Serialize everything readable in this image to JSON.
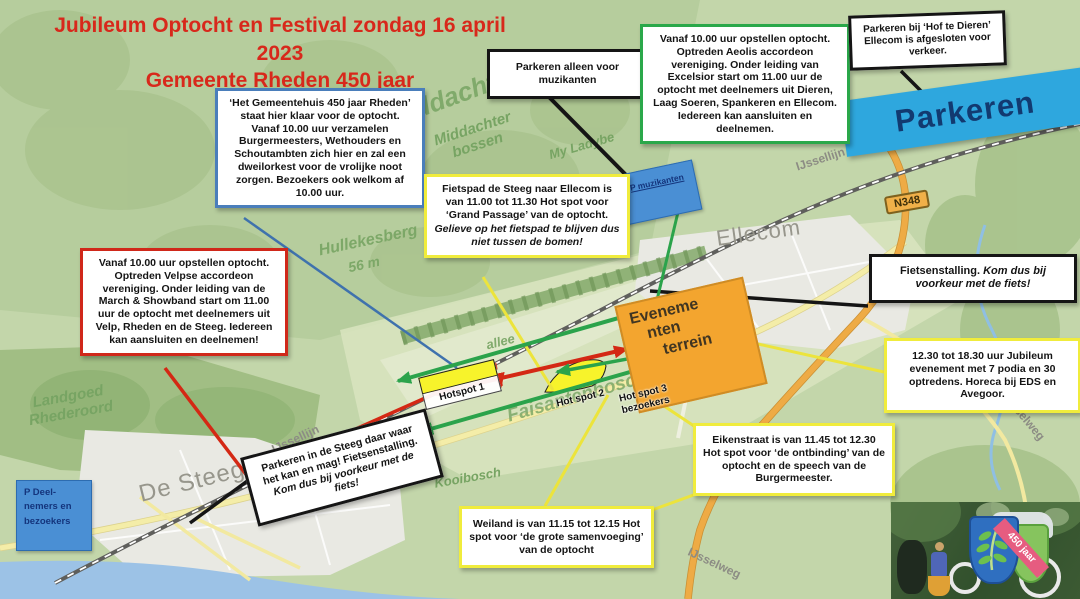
{
  "title": {
    "line1": "Jubileum Optocht en Festival zondag 16 april 2023",
    "line2": "Gemeente Rheden 450 jaar"
  },
  "callouts": {
    "gemeentehuis": {
      "text": "‘Het Gemeentehuis 450 jaar Rheden’ staat hier klaar voor de optocht. Vanaf 10.00 uur verzamelen Burgermeesters, Wethouders en Schoutambten zich hier en zal een dweilorkest voor de vrolijke noot zorgen. Bezoekers ook welkom af 10.00 uur."
    },
    "velp": {
      "text": "Vanaf 10.00 uur opstellen optocht. Optreden Velpse accordeon vereniging. Onder leiding van de March & Showband start om 11.00 uur de optocht met deelnemers uit Velp, Rheden en de Steeg. Iedereen kan aansluiten en deelnemen!"
    },
    "muzikanten": {
      "text": "Parkeren alleen voor muzikanten"
    },
    "dieren": {
      "text": "Vanaf 10.00 uur opstellen optocht. Optreden Aeolis accordeon vereniging. Onder leiding van Excelsior start om 11.00 uur de optocht met deelnemers uit Dieren, Laag Soeren, Spankeren en Ellecom. Iedereen kan aansluiten en deelnemen."
    },
    "hof_te_dieren": {
      "text": "Parkeren bij ‘Hof te Dieren’ Ellecom is afgesloten voor verkeer."
    },
    "fietspad": {
      "text": "Fietspad de Steeg naar Ellecom is van 11.00 tot 11.30 Hot spot voor ‘Grand Passage’ van de optocht.",
      "note": "Gelieve op het fietspad te blijven dus niet tussen de bomen!"
    },
    "fietsenstalling": {
      "lead": "Fietsenstalling.",
      "rest": "Kom dus bij voorkeur met de fiets!"
    },
    "jubileum": {
      "text": "12.30 tot 18.30 uur Jubileum evenement met 7 podia en 30 optredens. Horeca bij EDS en Avegoor."
    },
    "eikenstraat": {
      "text": "Eikenstraat is van 11.45 tot 12.30 Hot spot voor ‘de ontbinding’ van de optocht en de speech van de Burgermeester."
    },
    "weiland": {
      "text": "Weiland is van 11.15 tot 12.15 Hot spot voor ‘de grote samenvoeging’ van de optocht"
    },
    "parkeren_steeg": {
      "lead": "Parkeren in de Steeg daar waar het kan en mag! Fietsenstalling.",
      "rest": "Kom dus bij voorkeur met de fiets!"
    }
  },
  "signs": {
    "parkeren_banner": "Parkeren",
    "p_muzikanten": "P muzikanten",
    "p_deelnemers": {
      "lines": [
        "P Deel-",
        "nemers en",
        "bezoekers"
      ]
    },
    "evenemententerrein": {
      "lines": [
        "Eveneme",
        "nten",
        "terrein"
      ]
    },
    "hotspot1": "Hotspot 1",
    "hotspot2": "Hot spot 2",
    "hotspot3": {
      "lines": [
        "Hot spot 3",
        "bezoekers"
      ]
    }
  },
  "map_labels": {
    "middachten": "Middachten",
    "middachter_bossen": "Middachter bossen",
    "my_lady": "My Ladybe",
    "hullekesberg": "Hullekesberg",
    "hullekesberg_elevation": "56 m",
    "ellecom": "Ellecom",
    "n348": "N348",
    "ijssellijn_east": "IJssellijn",
    "ijssellijn_west": "IJssellijn",
    "de_steeg": "De Steeg",
    "landgoed_rhederoord": "Landgoed Rhederoord",
    "kooibosch": "Kooibosch",
    "faisantenbosch": "Faisantenbosch",
    "allee": "allee",
    "ijsselweg_east": "IJsselweg",
    "ijsselweg_south": "IJsselweg"
  },
  "logo": {
    "badge": "450 jaar"
  },
  "colors": {
    "title_red": "#d8281b",
    "border_blue": "#4a7ebb",
    "border_red": "#d0281a",
    "border_green": "#2aa84a",
    "border_yellow": "#f0ec3c",
    "border_black": "#151515",
    "sign_blue": "#4a8fd4",
    "banner_blue": "#2ea7de",
    "event_orange": "#f3a52f",
    "hotspot_yellow": "#f7f32b",
    "arrow_red": "#d42814",
    "arrow_green": "#2ba34b"
  }
}
